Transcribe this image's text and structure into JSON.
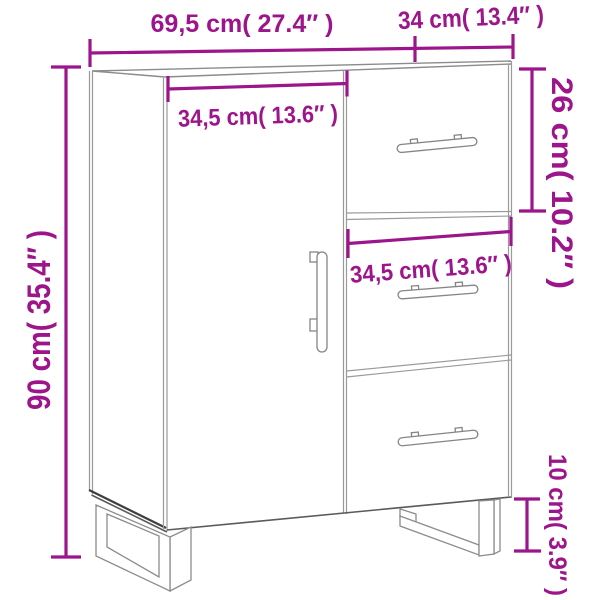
{
  "diagram": {
    "colors": {
      "accent": "#9D158B",
      "cabinet_line": "#8c8c8c",
      "cabinet_dark": "#3f3f3f",
      "background": "#ffffff"
    },
    "dimensions": {
      "width": {
        "label": "69,5 cm( 27.4″ )",
        "value_cm": 69.5,
        "value_in": 27.4
      },
      "depth": {
        "label": "34 cm( 13.4″ )",
        "value_cm": 34,
        "value_in": 13.4
      },
      "height": {
        "label": "90 cm( 35.4″ )",
        "value_cm": 90,
        "value_in": 35.4
      },
      "top_drawer": {
        "label": "26 cm( 10.2″ )",
        "value_cm": 26,
        "value_in": 10.2
      },
      "door_width": {
        "label": "34,5 cm( 13.6″ )",
        "value_cm": 34.5,
        "value_in": 13.6
      },
      "drawer_width": {
        "label": "34,5 cm( 13.6″ )",
        "value_cm": 34.5,
        "value_in": 13.6
      },
      "leg_height": {
        "label": "10 cm( 3.9″ )",
        "value_cm": 10,
        "value_in": 3.9
      }
    }
  }
}
